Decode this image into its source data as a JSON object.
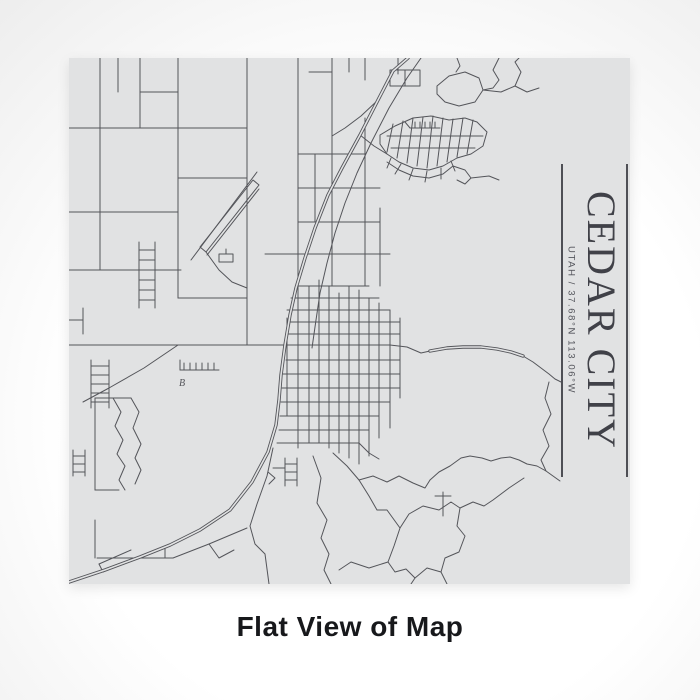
{
  "window": {
    "caption": "Flat View of Map"
  },
  "colors": {
    "page_light": "#ffffff",
    "page_dark": "#c7c7c8",
    "map_bg": "#e1e2e3",
    "road": "#54555a",
    "title": "#404148",
    "subtitle": "#54555c",
    "rule": "#4e4f55",
    "caption": "#17181b"
  },
  "map": {
    "title": "CEDAR CITY",
    "subtitle": "UTAH / 37.68°N 113.06°W",
    "label_b": "B",
    "roads": {
      "streets": [
        "31,0 31,212",
        "0,70 178,70",
        "71,0 71,70",
        "49,0 49,34",
        "71,34 109,34",
        "109,0 109,240",
        "178,0 178,287",
        "229,0 229,390",
        "0,154 109,154",
        "0,212 109,212",
        "109,240 178,240",
        "109,120 178,120",
        "0,287 321,287",
        "14,344 40,330 75,310 109,287",
        "0,262 14,262",
        "14,250 14,276",
        "70,184 70,250",
        "86,184 86,250",
        "70,192 86,192",
        "70,202 86,202",
        "70,212 86,212",
        "70,222 86,222",
        "70,232 86,232",
        "70,242 86,242",
        "86,212 112,212",
        "22,302 22,350",
        "40,302 40,350",
        "22,308 40,308",
        "22,317 40,317",
        "22,326 40,326",
        "22,335 40,335",
        "22,344 40,344",
        "4,392 4,418",
        "16,392 16,418",
        "4,398 16,398",
        "4,406 16,406",
        "4,414 16,414",
        "111,312 150,312",
        "111,312 111,302",
        "115,312 115,305",
        "121,312 121,305",
        "127,312 127,305",
        "133,312 133,305",
        "139,312 139,305",
        "145,312 145,305",
        "44,340 52,354 46,368 54,382 48,396 56,408 50,422 56,432",
        "62,340 70,354 64,370 72,386 66,400 72,412 66,426",
        "26,340 26,432",
        "26,340 62,340",
        "26,432 50,432",
        "26,462 26,500",
        "28,500 104,500",
        "96,488 96,500",
        "30,506 62,492",
        "34,514 66,500",
        "30,506 34,514",
        "104,500 140,486 178,470",
        "140,486 150,500 165,492",
        "138,197 190,131",
        "122,202 188,114",
        "157,196 157,191",
        "137,194 150,212 163,224 178,230",
        "229,96 296,96",
        "229,130 311,130",
        "229,164 311,164",
        "196,196 321,196",
        "296,60 296,228",
        "311,150 311,228",
        "246,96 246,164",
        "263,0 263,228",
        "280,0 280,14",
        "296,0 296,22",
        "329,0 329,16",
        "240,14 263,14",
        "336,12 336,28",
        "240,228 240,385",
        "250,222 250,385",
        "260,228 260,390",
        "270,235 270,395",
        "280,228 280,400",
        "290,232 290,406",
        "300,240 300,398",
        "310,245 310,380",
        "321,252 321,370",
        "331,260 331,340",
        "218,260 218,358",
        "229,228 300,228",
        "222,240 310,240",
        "218,252 321,252",
        "218,264 331,264",
        "217,276 331,276",
        "217,302 331,302",
        "214,316 331,316",
        "213,330 331,330",
        "212,344 321,344",
        "211,358 310,358",
        "210,372 300,372",
        "208,385 290,385 300,395 310,401",
        "204,390 198,418 188,446 181,468 186,486 196,496 200,526",
        "216,400 216,428",
        "228,400 228,428",
        "216,406 228,406",
        "216,414 228,414",
        "216,422 228,422",
        "204,410 216,410",
        "199,414 206,420 200,426",
        "244,398 252,420 248,445 258,462 252,480 260,496 255,512 262,526",
        "264,395 278,408 290,422 300,438 308,452 318,452 331,470",
        "290,422 304,418 318,424 330,418 344,425 356,430 361,422",
        "309,42 292,58 276,70 263,78",
        "291,77 305,88 318,96",
        "311,77 326,68 344,60 362,58 380,62 396,60 408,64 418,74 414,88 402,96 388,100 374,108 360,112 344,110 330,104 318,96 311,86 311,77",
        "324,66 318,94",
        "334,63 328,100",
        "344,60 338,105",
        "354,59 348,108",
        "364,58 358,110",
        "374,60 368,108",
        "384,61 378,104",
        "394,60 388,99",
        "404,62 398,96",
        "318,78 414,78",
        "322,90 406,90",
        "318,104 330,112 344,118 360,120 374,116 384,108",
        "322,100 318,110",
        "332,106 326,116",
        "344,111 340,122",
        "358,113 356,124",
        "372,110 372,121",
        "382,103 386,113",
        "384,108 396,112 402,120 396,126 388,122",
        "402,120 420,118 430,122",
        "336,64 341,70 371,70",
        "346,70 346,64",
        "351,70 351,64",
        "356,70 356,64",
        "361,70 361,64",
        "366,70 366,64",
        "368,28 380,18 396,14 410,20 414,32 406,44 390,48 376,44 368,36 368,28",
        "414,32 432,34 446,28 458,34 470,30",
        "388,0 391,8 387,14",
        "430,0 424,12 430,22 424,30 414,32",
        "446,28 452,14 446,4 450,0",
        "352,0 338,20 320,50 302,85 288,115 276,145 266,175 258,205 251,235 247,262 243,290",
        "321,287 338,289 352,295 361,293 378,290 394,289 412,289 428,291 442,294 454,298 464,304 472,310 480,316 486,321 492,324",
        "480,324 476,340 482,356 474,372 480,388 472,402 477,413",
        "361,422 370,414 381,408 392,400 401,398 413,400 422,403 432,400 441,399 450,402 458,406 468,408 477,413 484,418 491,423",
        "331,470 340,456 354,448 370,452 382,444 391,450 388,468 396,478 390,494 376,500 372,514 358,510 346,520 337,511 326,514 319,504 325,488 331,470",
        "374,434 374,458",
        "366,438 382,438",
        "372,514 378,526",
        "346,520 342,526",
        "391,450 404,444 415,448 424,442 440,430 455,420",
        "319,504 300,510 282,504 270,512"
      ],
      "blocks": [
        "131,189 184,122 190,127 137,194",
        "150,196 164,196 164,204 150,204",
        "321,12 351,12 351,28 321,28"
      ],
      "highways": [
        "339,0 324,13 309,42 291,77 273,110 259,137 246,170 236,200 227,230 221,257 216,287 212,317 210,342 207,367 199,394 183,424 161,452 131,472 101,487 71,499 36,512 0,524",
        "361,293 378,290 394,289 412,289 428,291 442,294 454,298"
      ]
    }
  }
}
